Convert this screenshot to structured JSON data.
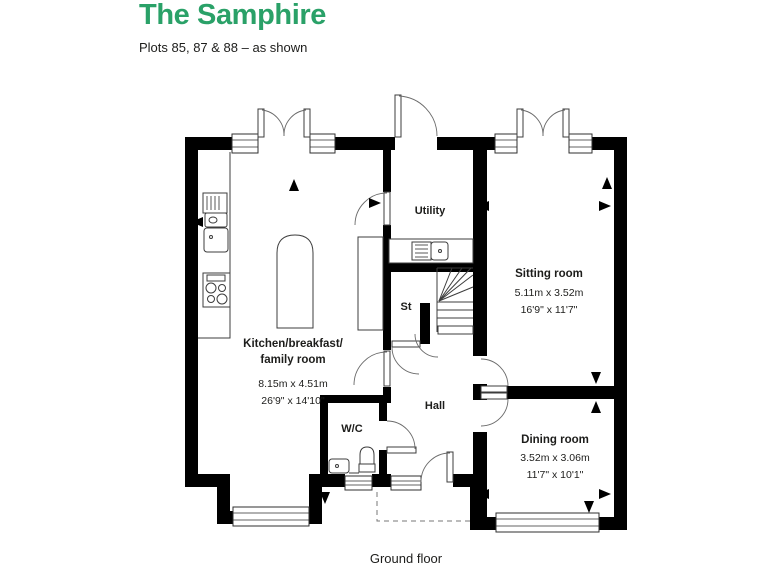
{
  "header": {
    "title": "The Samphire",
    "subtitle": "Plots 85, 87 & 88 – as shown"
  },
  "floorplan": {
    "caption": "Ground floor",
    "rooms": {
      "kitchen": {
        "name_line1": "Kitchen/breakfast/",
        "name_line2": "family room",
        "metric": "8.15m x 4.51m",
        "imperial": "26'9\" x 14'10\""
      },
      "sitting": {
        "name": "Sitting room",
        "metric": "5.11m x 3.52m",
        "imperial": "16'9\" x 11'7\""
      },
      "dining": {
        "name": "Dining room",
        "metric": "3.52m x 3.06m",
        "imperial": "11'7\" x 10'1\""
      },
      "utility": {
        "name": "Utility"
      },
      "hall": {
        "name": "Hall"
      },
      "store": {
        "name": "St"
      },
      "wc": {
        "name": "W/C"
      }
    }
  },
  "colors": {
    "accent_green": "#2aa168",
    "text": "#1d1d1b",
    "wall": "#000000"
  }
}
